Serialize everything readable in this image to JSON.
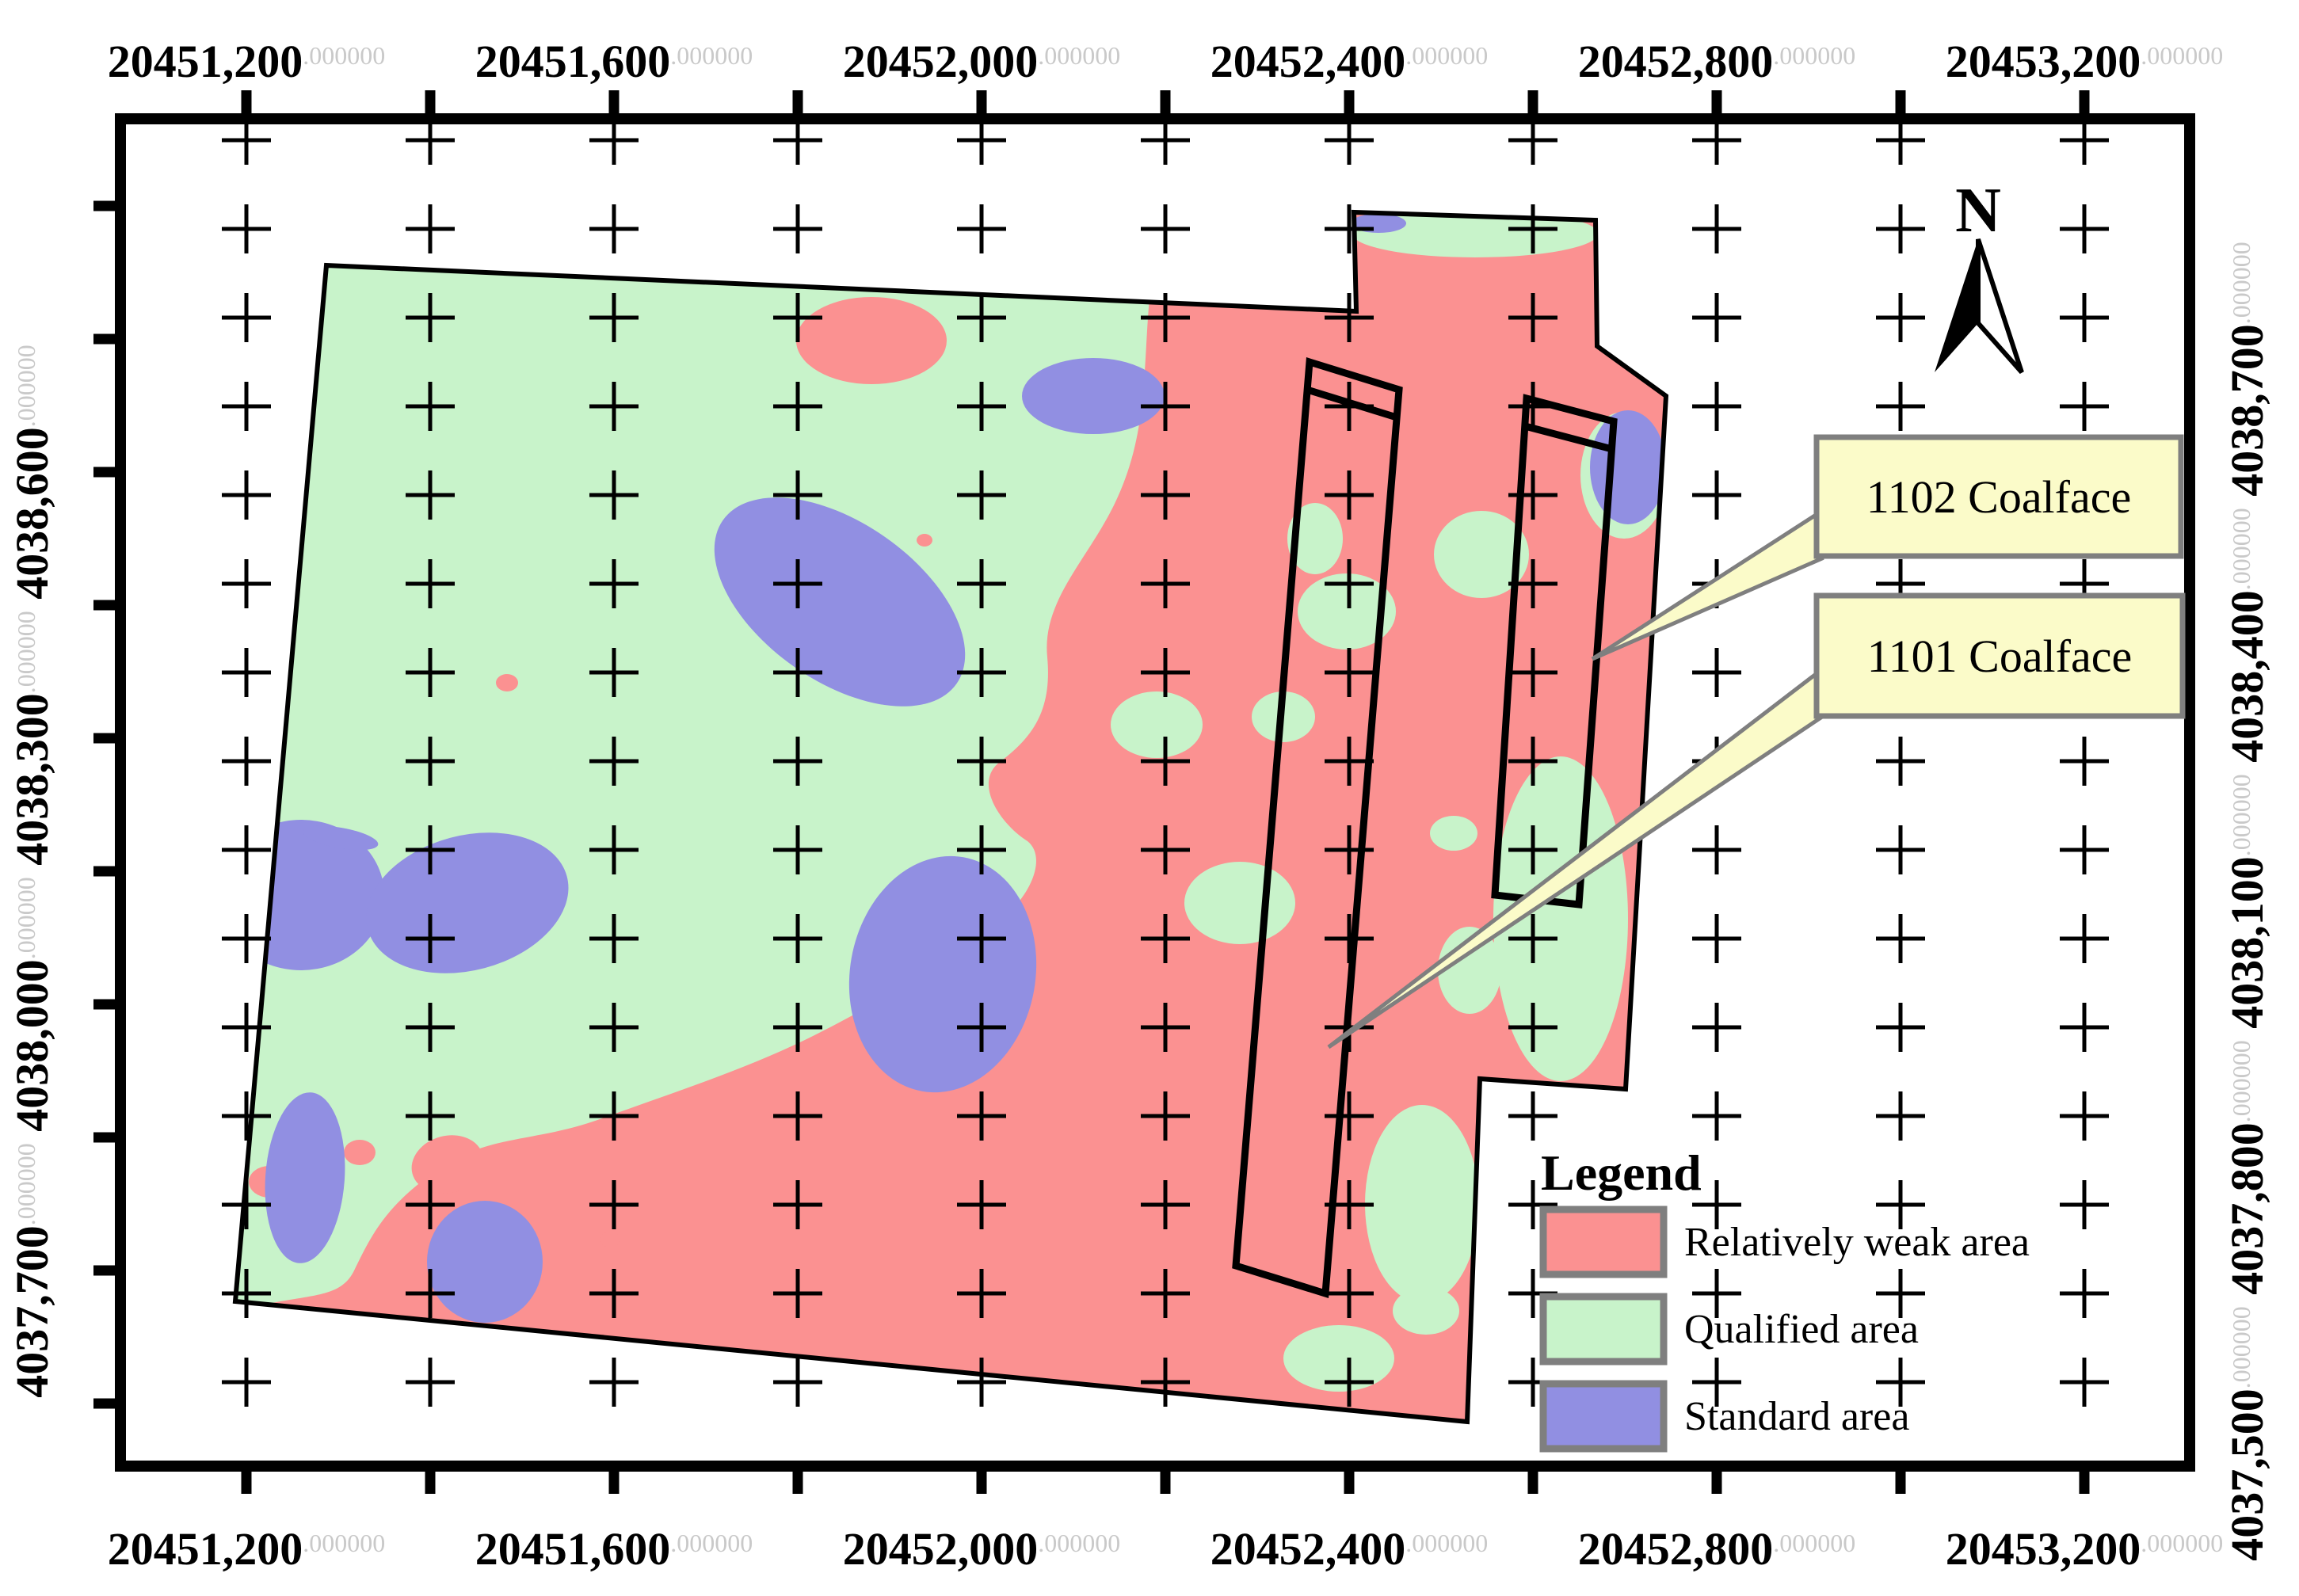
{
  "figure": {
    "kind": "coal-mine zonation map",
    "background": "#ffffff"
  },
  "axes": {
    "decimal_suffix": ".000000",
    "x_labels": [
      "20451,200",
      "20451,600",
      "20452,000",
      "20452,400",
      "20452,800",
      "20453,200"
    ],
    "y_left_labels": [
      "4038,600",
      "4038,300",
      "4038,000",
      "4037,700"
    ],
    "y_right_labels": [
      "4038,700",
      "4038,400",
      "4038,100",
      "4037,800",
      "4037,500"
    ]
  },
  "legend": {
    "title": "Legend",
    "items": [
      {
        "label": "Relatively weak area",
        "color": "#FB9191"
      },
      {
        "label": "Qualified area",
        "color": "#C8F3CA"
      },
      {
        "label": "Standard area",
        "color": "#918FE2"
      }
    ]
  },
  "callouts": [
    {
      "label": "1102 Coalface"
    },
    {
      "label": "1101 Coalface"
    }
  ],
  "north_arrow": {
    "label": "N"
  },
  "colors": {
    "weak_area": "#FB9191",
    "qualified_area": "#C8F3CA",
    "standard_area": "#918FE2",
    "callout_fill": "#FBFBC9",
    "callout_border": "#7F7F7F",
    "suffix_gray": "#C9C9C9",
    "frame": "#000000"
  },
  "chart_data": {
    "type": "map",
    "title": "",
    "x_axis": {
      "tick_labels": [
        "20451,200",
        "20451,600",
        "20452,000",
        "20452,400",
        "20452,800",
        "20453,200"
      ],
      "decimal_suffix": ".000000"
    },
    "y_axis_left": {
      "tick_labels": [
        "4038,600",
        "4038,300",
        "4038,000",
        "4037,700"
      ],
      "decimal_suffix": ".000000"
    },
    "y_axis_right": {
      "tick_labels": [
        "4038,700",
        "4038,400",
        "4038,100",
        "4037,800",
        "4037,500"
      ],
      "decimal_suffix": ".000000"
    },
    "zones": [
      "Relatively weak area",
      "Qualified area",
      "Standard area"
    ],
    "features": [
      "1102 Coalface",
      "1101 Coalface"
    ],
    "north_arrow": true,
    "grid": "plus-cross reference grid over map"
  }
}
